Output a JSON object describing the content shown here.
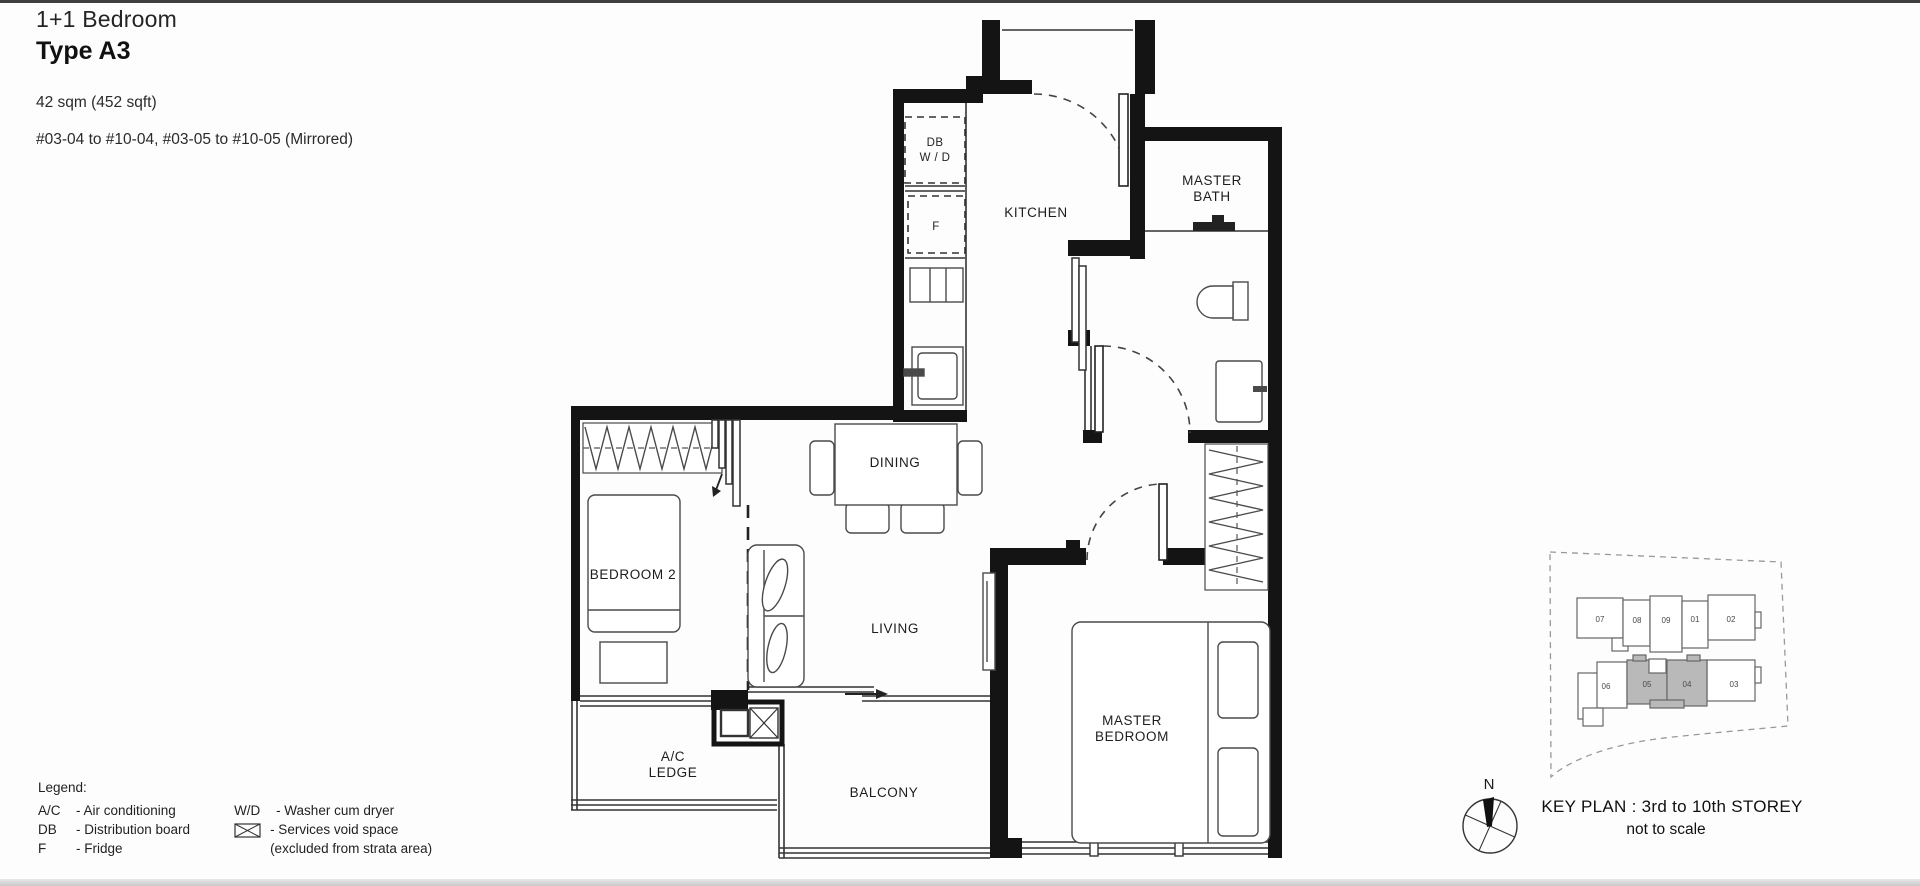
{
  "header": {
    "category": "1+1 Bedroom",
    "type": "Type A3",
    "area": "42 sqm (452 sqft)",
    "units": "#03-04 to #10-04, #03-05 to #10-05 (Mirrored)"
  },
  "plan": {
    "labels": {
      "kitchen": "KITCHEN",
      "master_bath_l1": "MASTER",
      "master_bath_l2": "BATH",
      "dining": "DINING",
      "bedroom2": "BEDROOM 2",
      "living": "LIVING",
      "master_bedroom_l1": "MASTER",
      "master_bedroom_l2": "BEDROOM",
      "ac_ledge_l1": "A/C",
      "ac_ledge_l2": "LEDGE",
      "balcony": "BALCONY",
      "db_l1": "DB",
      "db_l2": "W / D",
      "fridge": "F"
    }
  },
  "legend": {
    "title": "Legend:",
    "left": [
      [
        "A/C",
        "- Air conditioning"
      ],
      [
        "DB",
        "- Distribution board"
      ],
      [
        "F",
        "- Fridge"
      ]
    ],
    "right_row1": [
      "W/D",
      "- Washer cum dryer"
    ],
    "right_row2": "- Services void space",
    "right_row3": "(excluded from strata area)"
  },
  "key_plan": {
    "north_label": "N",
    "title": "KEY PLAN : 3rd to 10th STOREY",
    "subtitle": "not to scale",
    "units_top": [
      "07",
      "08",
      "09",
      "01",
      "02"
    ],
    "units_bottom": [
      "06",
      "05",
      "04",
      "03"
    ],
    "highlighted_units": [
      "05",
      "04"
    ],
    "highlight_color": "#b9b9b9"
  }
}
